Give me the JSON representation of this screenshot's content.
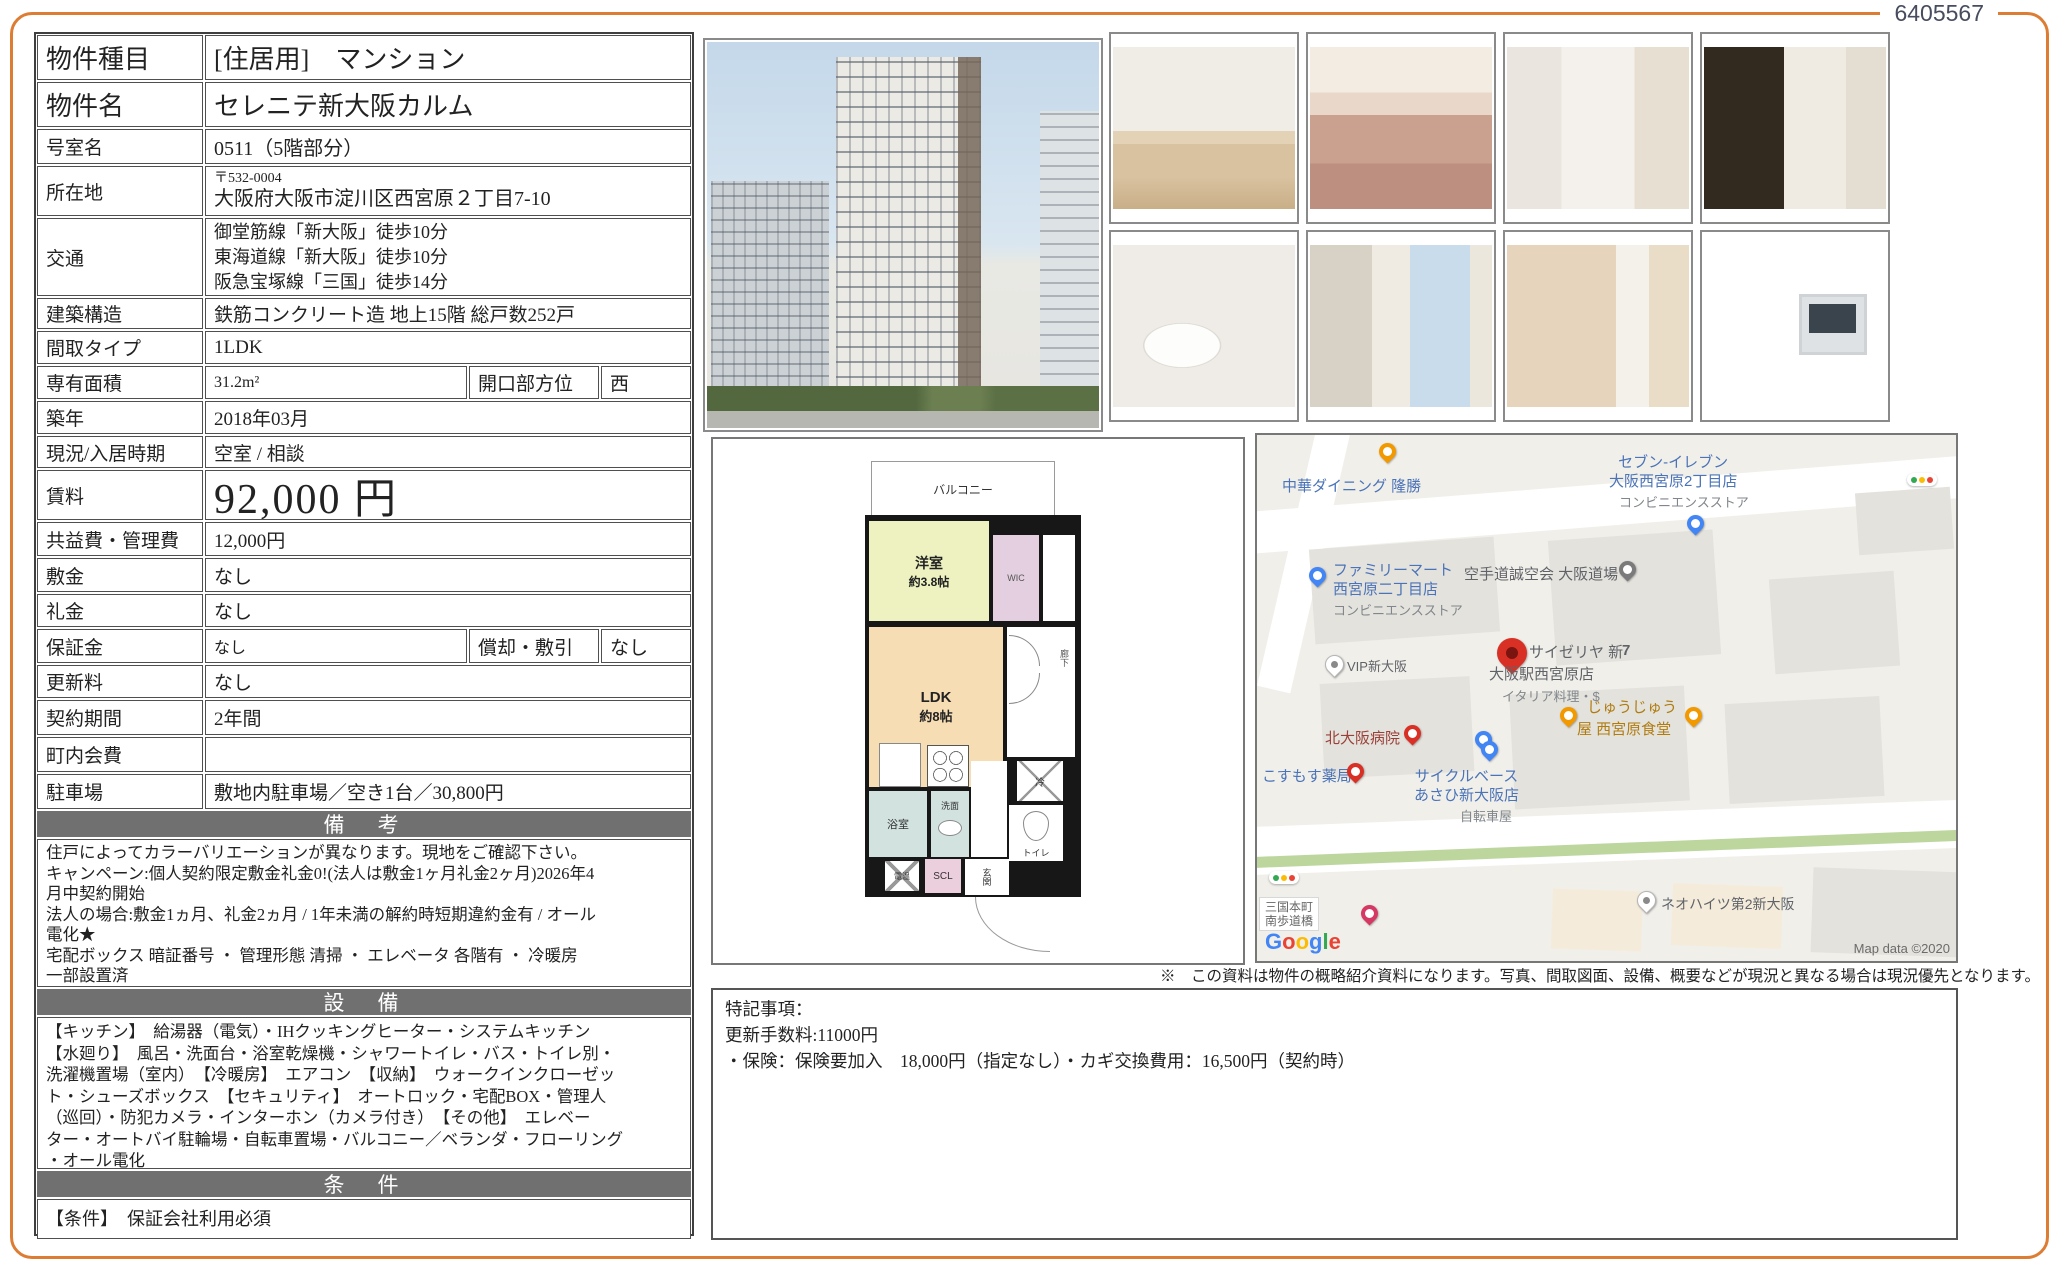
{
  "doc_number": "6405567",
  "colors": {
    "accent_orange": "#dd7d33",
    "section_bar_gray": "#707070",
    "map_label_blue": "#4a73b8",
    "plan_room_green": "#edf2c0",
    "plan_room_peach": "#f7ddb4",
    "plan_wic_pink": "#e3cfe0"
  },
  "property": {
    "rows": [
      {
        "label": "物件種目",
        "value": "[住居用]　マンション"
      },
      {
        "label": "物件名",
        "value": "セレニテ新大阪カルム"
      },
      {
        "label": "号室名",
        "value": "0511（5階部分）"
      },
      {
        "label": "所在地",
        "postal": "〒532-0004",
        "value": "大阪府大阪市淀川区西宮原２丁目7-10"
      },
      {
        "label": "交通",
        "lines": [
          "御堂筋線「新大阪」徒歩10分",
          "東海道線「新大阪」徒歩10分",
          "阪急宝塚線「三国」徒歩14分"
        ]
      },
      {
        "label": "建築構造",
        "value": "鉄筋コンクリート造 地上15階 総戸数252戸"
      },
      {
        "label": "間取タイプ",
        "value": "1LDK"
      },
      {
        "label": "専有面積",
        "value": "31.2m²",
        "label2": "開口部方位",
        "value2": "西"
      },
      {
        "label": "築年",
        "value": "2018年03月"
      },
      {
        "label": "現況/入居時期",
        "value": "空室 /  相談"
      },
      {
        "label": "賃料",
        "value": "92,000 円"
      },
      {
        "label": "共益費・管理費",
        "value": "12,000円"
      },
      {
        "label": "敷金",
        "value": "なし"
      },
      {
        "label": "礼金",
        "value": "なし"
      },
      {
        "label": "保証金",
        "value": "なし",
        "label2": "償却・敷引",
        "value2": "なし"
      },
      {
        "label": "更新料",
        "value": "なし"
      },
      {
        "label": "契約期間",
        "value": "2年間"
      },
      {
        "label": "町内会費",
        "value": ""
      },
      {
        "label": "駐車場",
        "value": "敷地内駐車場／空き1台／30,800円"
      }
    ]
  },
  "sections": {
    "biko": {
      "title": "備　考",
      "lines": [
        "住戸によってカラーバリエーションが異なります。現地をご確認下さい。",
        "キャンペーン:個人契約限定敷金礼金0!(法人は敷金1ヶ月礼金2ヶ月)2026年4",
        "月中契約開始",
        "法人の場合:敷金1ヵ月、礼金2ヵ月 / 1年未満の解約時短期違約金有 / オール",
        "電化★",
        "宅配ボックス 暗証番号 ・ 管理形態 清掃 ・ エレベータ 各階有 ・ 冷暖房",
        "一部設置済"
      ]
    },
    "setsubi": {
      "title": "設　備",
      "lines": [
        "【キッチン】　給湯器（電気）・IHクッキングヒーター・システムキッチン",
        "【水廻り】　風呂・洗面台・浴室乾燥機・シャワートイレ・バス・トイレ別・",
        "洗濯機置場（室内）　【冷暖房】　エアコン　【収納】　ウォークインクローゼッ",
        "ト・シューズボックス　【セキュリティ】　オートロック・宅配BOX・管理人",
        "（巡回）・防犯カメラ・インターホン（カメラ付き）　【その他】　エレベー",
        "ター・オートバイ駐輪場・自転車置場・バルコニー／ベランダ・フローリング",
        "・オール電化"
      ]
    },
    "joken": {
      "title": "条　件",
      "text": "【条件】　保証会社利用必須"
    }
  },
  "floorplan": {
    "balcony": "バルコニー",
    "room1": "洋室",
    "room1_size": "約3.8帖",
    "wic": "WIC",
    "ldk": "LDK",
    "ldk_size": "約8帖",
    "hall": "廊下",
    "fridge": "冷",
    "toilet": "トイレ",
    "bath": "浴室",
    "wash": "洗面",
    "heater": "電温",
    "scl": "SCL",
    "entrance": "玄関"
  },
  "photos": {
    "building": "building-exterior",
    "items": [
      "living-room",
      "kitchen",
      "washroom-corridor",
      "bathroom",
      "toilet",
      "bedroom",
      "walk-in-closet",
      "intercom-monitor"
    ]
  },
  "map": {
    "chuka": "中華ダイニング 隆勝",
    "seven1": "セブン-イレブン",
    "seven2": "大阪西宮原2丁目店",
    "seven_sub": "コンビニエンスストア",
    "famima1": "ファミリーマート",
    "famima2": "西宮原二丁目店",
    "famima_sub": "コンビニエンスストア",
    "karate": "空手道誠空会 大阪道場",
    "vip": "VIP新大阪",
    "saize1": "サイゼリヤ 新",
    "saize_no": "7",
    "saize2": "大阪駅西宮原店",
    "saize_sub": "イタリア料理・$",
    "jujuya1": "じゅうじゅう",
    "jujuya2": "屋 西宮原食堂",
    "hospital": "北大阪病院",
    "kosumosu": "こすもす薬局",
    "cycle1": "サイクルベース",
    "cycle2": "あさひ新大阪店",
    "cycle_sub": "自転車屋",
    "neo": "ネオハイツ第2新大阪",
    "bridge1": "三国本町",
    "bridge2": "南歩道橋",
    "google_letters": [
      "G",
      "o",
      "o",
      "g",
      "l",
      "e"
    ],
    "credit": "Map data ©2020"
  },
  "disclaimer": "※　この資料は物件の概略紹介資料になります。写真、間取図面、設備、概要などが現況と異なる場合は現況優先となります。",
  "notes": {
    "lines": [
      "特記事項：",
      "更新手数料:11000円",
      "・保険：保険要加入　18,000円（指定なし）・カギ交換費用：16,500円（契約時）"
    ]
  }
}
